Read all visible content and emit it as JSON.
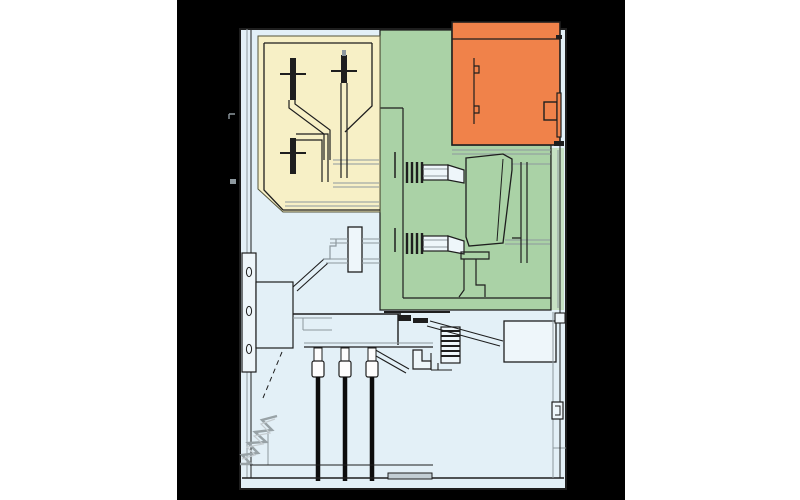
{
  "diagram": {
    "type": "technical cross-section",
    "subject": "switchgear cubicle side view",
    "compartments": [
      {
        "id": "busbar_compartment",
        "position": "top-left",
        "color": "#f7f0c6"
      },
      {
        "id": "circuit_breaker_compartment",
        "position": "center",
        "color": "#aad2a6"
      },
      {
        "id": "low_voltage_compartment",
        "position": "top-right",
        "color": "#f0824a"
      },
      {
        "id": "cable_compartment",
        "position": "bottom",
        "color": "#e3f0f7"
      }
    ],
    "components": [
      "busbars-with-bolted-joints",
      "circuit-breaker-with-bushings",
      "low-voltage-box-with-hinges-and-handle",
      "operating-mechanism-plate-and-box",
      "drive-shaft-bearing",
      "current-transformer-stack",
      "cable-terminations",
      "power-cables",
      "earthing-spring",
      "support-struts",
      "junction-box"
    ]
  },
  "canvas": {
    "width": 800,
    "height": 500,
    "page_background": "#ffffff",
    "panel_background": "#000000"
  },
  "colors": {
    "panel_background": "#000000",
    "cabinet_fill": "#e3f0f7",
    "wall_fill": "#dcedf4",
    "busbar_fill": "#f7f0c6",
    "breaker_fill": "#aad2a6",
    "breaker_strip_fill": "#c7e2c4",
    "lv_fill": "#f0824a",
    "component_fill": "#eef6fa",
    "white_fill": "#fdfdfd",
    "outline": "#1e1e1e",
    "line_gray": "#8d989e",
    "cable_black": "#0d0d0d",
    "sill_gray": "#c2ced4",
    "spring_gray": "#98a2a6"
  }
}
